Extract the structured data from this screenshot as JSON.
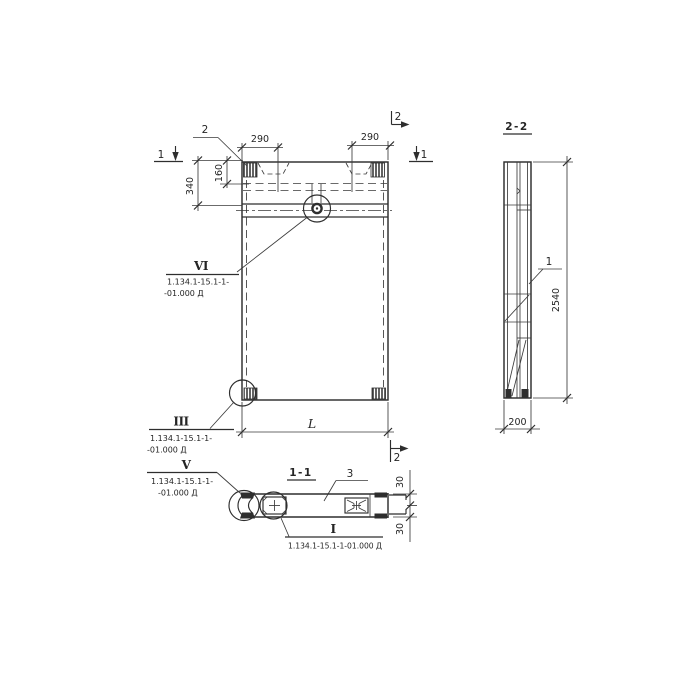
{
  "drawing": {
    "ink_color": "#2e2e2e",
    "paper_color": "#ffffff"
  },
  "front_view": {
    "section_mark_1_left": "1",
    "section_mark_1_right": "1",
    "section_mark_2_top": "2",
    "section_mark_2_bottom": "2",
    "leader_item_2": "2",
    "dim_290_left": "290",
    "dim_290_right": "290",
    "dim_340": "340",
    "dim_160": "160",
    "dim_length": "L",
    "detail_vi": {
      "numeral": "VI",
      "doc_line1": "1.134.1-15.1-1-",
      "doc_line2": "-01.000 Д"
    },
    "detail_iii": {
      "numeral": "III",
      "doc_line1": "1.134.1-15.1-1-",
      "doc_line2": "-01.000 Д"
    }
  },
  "section_2_2": {
    "title": "2-2",
    "dim_height": "2540",
    "dim_width": "200",
    "leader_item_1": "1"
  },
  "section_1_1": {
    "title": "1-1",
    "leader_item_3": "3",
    "dim_30_top": "30",
    "dim_30_bottom": "30",
    "detail_v": {
      "numeral": "V",
      "doc_line1": "1.134.1-15.1-1-",
      "doc_line2": "-01.000 Д"
    },
    "detail_i": {
      "numeral": "I",
      "doc_line": "1.134.1-15.1-1-01.000 Д"
    }
  }
}
